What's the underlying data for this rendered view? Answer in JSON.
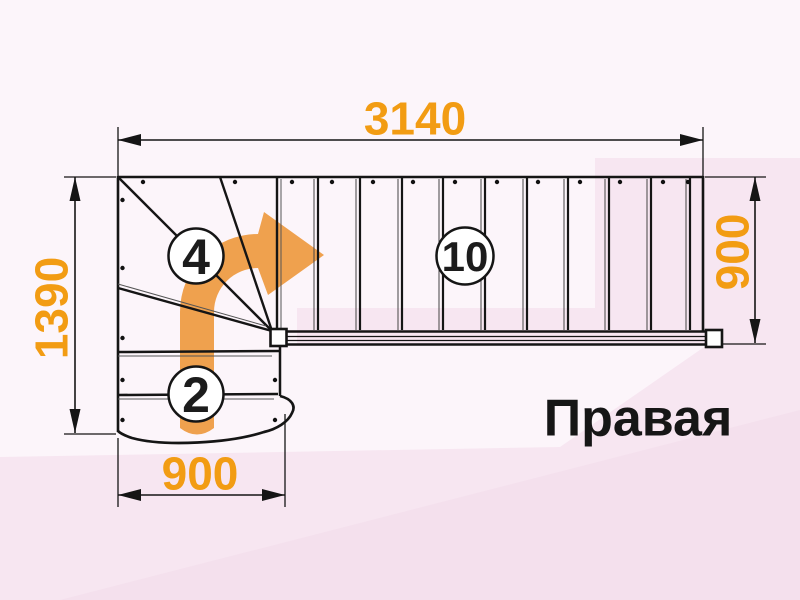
{
  "diagram": {
    "title": "Правая",
    "dimensions": {
      "top": "3140",
      "left": "1390",
      "right": "900",
      "bottom": "900"
    },
    "step_counts": {
      "winder_turn": "4",
      "upper_flight": "10",
      "lower_flight": "2"
    },
    "colors": {
      "dimension_text": "#F29C13",
      "direction_arrow": "#EFA14E",
      "outline": "#151515",
      "background": "#FCF5FA",
      "background_accent": "#F7E6F1",
      "title_text": "#161616"
    }
  }
}
